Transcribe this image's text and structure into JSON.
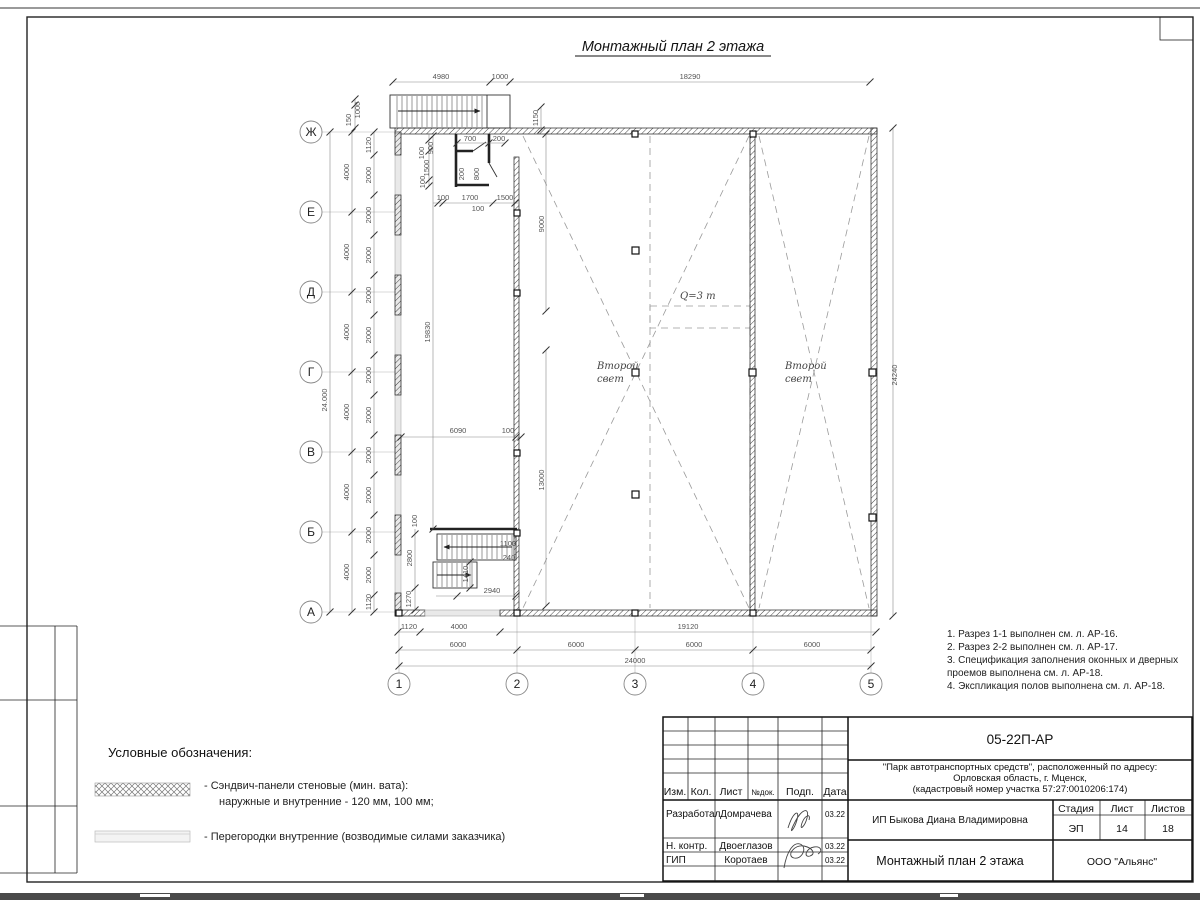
{
  "page": {
    "title": "Монтажный план 2 этажа"
  },
  "plan": {
    "row_axes": [
      "Ж",
      "Е",
      "Д",
      "Г",
      "В",
      "Б",
      "А"
    ],
    "col_axes": [
      "1",
      "2",
      "3",
      "4",
      "5"
    ],
    "labels": {
      "second_light1": "Второй",
      "second_light2": "свет",
      "crane": "Q=3 т"
    },
    "dims": {
      "top": [
        "4980",
        "1000",
        "18290"
      ],
      "landing": [
        "150",
        "1000"
      ],
      "opening_top": "1150",
      "axis_left": [
        "4000",
        "4000",
        "4000",
        "4000",
        "4000",
        "4000"
      ],
      "axis_left_total": "24.000",
      "left_chain_first": "1120",
      "left_chain": [
        "2000",
        "2000",
        "2000",
        "2000",
        "2000",
        "2000",
        "2000",
        "2000",
        "2000",
        "2000",
        "2000"
      ],
      "left_chain_last": "1120",
      "corridor_length": "19830",
      "room": [
        "700",
        "200",
        "100",
        "900",
        "1500",
        "100",
        "200",
        "800",
        "100",
        "1700",
        "1500",
        "100"
      ],
      "corridor_width": "6090",
      "wall_gap": "100",
      "wall_upper": "9000",
      "wall_lower": "13000",
      "stair": [
        "100",
        "1100",
        "240",
        "2800",
        "1410",
        "1270",
        "2940"
      ],
      "bottom_row1": [
        "1120",
        "4000",
        "19120"
      ],
      "bottom_spans": [
        "6000",
        "6000",
        "6000",
        "6000"
      ],
      "bottom_total": "24000",
      "right_total": "24240"
    }
  },
  "notes": [
    "1. Разрез 1-1 выполнен см. л. АР-16.",
    "2. Разрез 2-2 выполнен см. л. АР-17.",
    "3. Спецификация заполнения оконных и дверных",
    "    проемов выполнена см. л. АР-18.",
    "4. Экспликация полов выполнена см. л. АР-18."
  ],
  "legend": {
    "title": "Условные обозначения:",
    "item1_line1": "- Сэндвич-панели стеновые (мин. вата):",
    "item1_line2": "наружные и внутренние - 120 мм, 100 мм;",
    "item2": "- Перегородки внутренние (возводимые силами заказчика)"
  },
  "title_block": {
    "doc_number": "05-22П-АР",
    "project_line1": "\"Парк автотранспортных средств\",  расположенный по адресу:",
    "project_line2": "Орловская область, г. Мценск,",
    "project_line3": "(кадастровый номер участка 57:27:0010206:174)",
    "headers": [
      "Изм.",
      "Кол.",
      "Лист",
      "№док.",
      "Подп.",
      "Дата"
    ],
    "rows": [
      {
        "role": "Разработал",
        "name": "Домрачева",
        "date": "03.22"
      },
      {
        "role": "Н. контр.",
        "name": "Двоеглазов",
        "date": "03.22"
      },
      {
        "role": "ГИП",
        "name": "Коротаев",
        "date": "03.22"
      }
    ],
    "client": "ИП Быкова Диана Владимировна",
    "sheet_title": "Монтажный план 2 этажа",
    "stage_headers": [
      "Стадия",
      "Лист",
      "Листов"
    ],
    "stage": "ЭП",
    "sheet_no": "14",
    "sheets_total": "18",
    "company": "ООО \"Альянс\""
  }
}
